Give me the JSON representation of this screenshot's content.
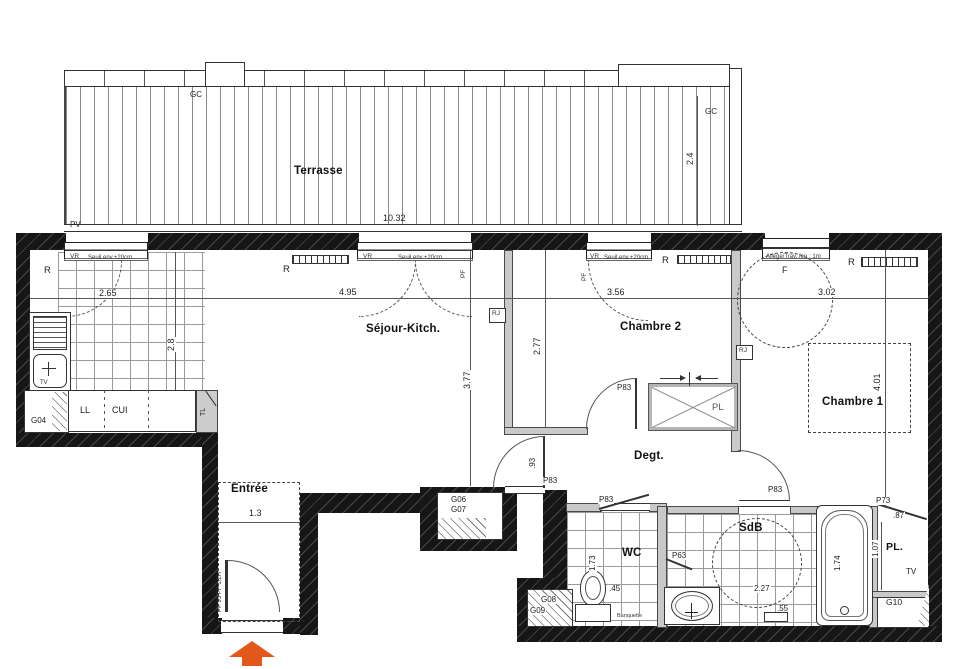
{
  "title": "Apartment floor plan",
  "rooms": {
    "terrasse": "Terrasse",
    "sejour": "Séjour-Kitch.",
    "chambre2": "Chambre 2",
    "chambre1": "Chambre 1",
    "entree": "Entrée",
    "degt": "Degt.",
    "wc": "WC",
    "sdb": "SdB",
    "placard": "PL.",
    "placard2": "PL"
  },
  "dimensions": {
    "terrasse_w": "10.32",
    "terrasse_d": "2.4",
    "kitchen_w": "2.65",
    "kitchen_d": "2.8",
    "sejour_w": "4.95",
    "sejour_d": "3.77",
    "ch2_w": "3.56",
    "ch2_d": "2.77",
    "ch1_w": "3.02",
    "ch1_d": "4.01",
    "entree_w": "1.3",
    "degt_w": ".93",
    "wc_d": "1.73",
    "wc_w": ".45",
    "sdb_w": "2.27",
    "sdb_s": ".55",
    "bath_l": "1.74",
    "pl_w": ".87",
    "pl_d": "1.07"
  },
  "openings": {
    "vr": "VR",
    "seuil": "Seuil env.+20cm",
    "pf": "PF",
    "f": "F",
    "allege": "Allège/Trav. fen : 1m",
    "p83": "P83",
    "p73": "P73",
    "p63": "P63",
    "entrance_door": "PP 93 PF 1/2H",
    "pv": "PV",
    "gc": "GC",
    "tl": "TL"
  },
  "ducts": {
    "g04": "G04",
    "g06": "G06",
    "g07": "G07",
    "g08": "G08",
    "g09": "G09",
    "g10": "G10"
  },
  "equipment": {
    "radiator": "R",
    "rj": "RJ",
    "washer": "LL",
    "cooker": "CUI",
    "tv": "TV",
    "banquette": "Banquette"
  },
  "colors": {
    "entrance_arrow": "#e2571a",
    "wall": "#161616"
  }
}
